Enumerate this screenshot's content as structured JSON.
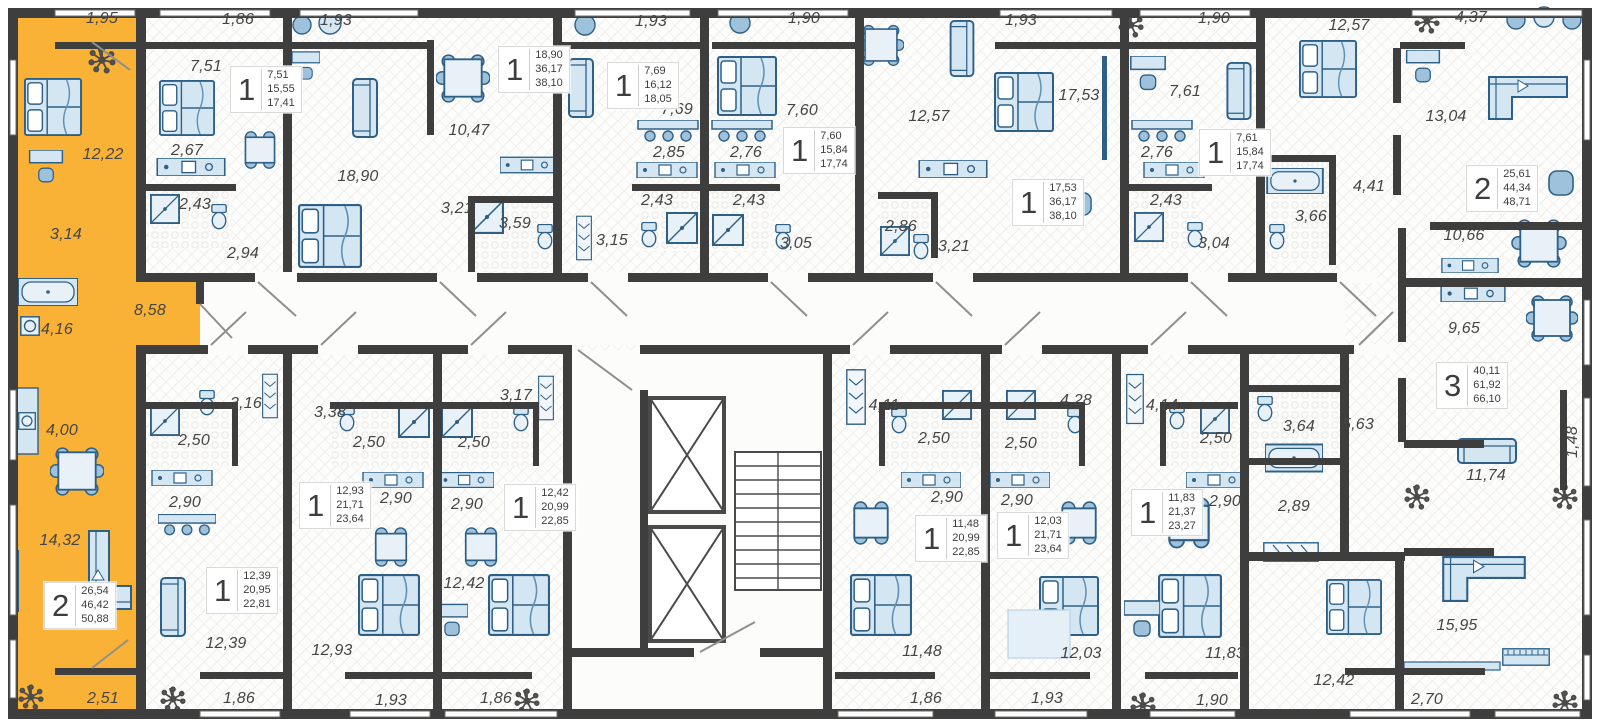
{
  "plan": {
    "wall_color": "#3E3E3E",
    "highlight_color": "#F9B236",
    "furniture_fill": "#D5E6F3",
    "furniture_stroke": "#2E6087",
    "label_color": "#454545"
  },
  "units": [
    {
      "id": "selected-2room",
      "type": "2",
      "highlighted": true,
      "badge": {
        "rooms": "2",
        "areas": [
          "26,54",
          "46,42",
          "50,88"
        ],
        "x": 44,
        "y": 582
      },
      "rooms": [
        {
          "label": "1,95",
          "x": 102,
          "y": 19
        },
        {
          "label": "12,22",
          "x": 103,
          "y": 155
        },
        {
          "label": "3,14",
          "x": 66,
          "y": 235
        },
        {
          "label": "4,16",
          "x": 57,
          "y": 330
        },
        {
          "label": "8,58",
          "x": 150,
          "y": 311
        },
        {
          "label": "4,00",
          "x": 62,
          "y": 431
        },
        {
          "label": "14,32",
          "x": 60,
          "y": 541
        },
        {
          "label": "2,51",
          "x": 103,
          "y": 699
        }
      ]
    },
    {
      "id": "unit-1-a",
      "type": "1",
      "badge": {
        "rooms": "1",
        "areas": [
          "7,51",
          "15,55",
          "17,41"
        ],
        "x": 230,
        "y": 66
      },
      "rooms": [
        {
          "label": "1,86",
          "x": 238,
          "y": 20
        },
        {
          "label": "7,51",
          "x": 206,
          "y": 67
        },
        {
          "label": "2,67",
          "x": 187,
          "y": 151
        },
        {
          "label": "2,43",
          "x": 195,
          "y": 205
        },
        {
          "label": "2,94",
          "x": 243,
          "y": 254
        }
      ]
    },
    {
      "id": "studio-a",
      "type": "1",
      "badge": {
        "rooms": "1",
        "areas": [
          "18,90",
          "36,17",
          "38,10"
        ],
        "x": 498,
        "y": 46
      },
      "rooms": [
        {
          "label": "1,93",
          "x": 336,
          "y": 21
        },
        {
          "label": "18,90",
          "x": 358,
          "y": 177
        },
        {
          "label": "10,47",
          "x": 469,
          "y": 131
        },
        {
          "label": "3,21",
          "x": 457,
          "y": 209
        },
        {
          "label": "3,59",
          "x": 515,
          "y": 224
        }
      ]
    },
    {
      "id": "unit-1-b",
      "type": "1",
      "badge": {
        "rooms": "1",
        "areas": [
          "7,69",
          "16,12",
          "18,05"
        ],
        "x": 607,
        "y": 62
      },
      "rooms": [
        {
          "label": "1,93",
          "x": 651,
          "y": 22
        },
        {
          "label": "7,69",
          "x": 677,
          "y": 110
        },
        {
          "label": "2,85",
          "x": 669,
          "y": 153
        },
        {
          "label": "2,43",
          "x": 657,
          "y": 201
        },
        {
          "label": "3,15",
          "x": 612,
          "y": 241
        }
      ]
    },
    {
      "id": "unit-1-c",
      "type": "1",
      "badge": {
        "rooms": "1",
        "areas": [
          "7,60",
          "15,84",
          "17,74"
        ],
        "x": 783,
        "y": 127
      },
      "rooms": [
        {
          "label": "1,90",
          "x": 804,
          "y": 19
        },
        {
          "label": "7,60",
          "x": 802,
          "y": 111
        },
        {
          "label": "2,76",
          "x": 746,
          "y": 153
        },
        {
          "label": "2,43",
          "x": 749,
          "y": 201
        },
        {
          "label": "3,05",
          "x": 796,
          "y": 244
        }
      ]
    },
    {
      "id": "studio-b",
      "type": "1",
      "badge": {
        "rooms": "1",
        "areas": [
          "17,53",
          "36,17",
          "38,10"
        ],
        "x": 1012,
        "y": 179
      },
      "rooms": [
        {
          "label": "12,57",
          "x": 929,
          "y": 117
        },
        {
          "label": "1,93",
          "x": 1021,
          "y": 21
        },
        {
          "label": "17,53",
          "x": 1079,
          "y": 96
        },
        {
          "label": "2,86",
          "x": 901,
          "y": 227
        },
        {
          "label": "3,21",
          "x": 954,
          "y": 247
        }
      ]
    },
    {
      "id": "unit-1-d",
      "type": "1",
      "badge": {
        "rooms": "1",
        "areas": [
          "7,61",
          "15,84",
          "17,74"
        ],
        "x": 1199,
        "y": 129
      },
      "rooms": [
        {
          "label": "1,90",
          "x": 1214,
          "y": 19
        },
        {
          "label": "7,61",
          "x": 1185,
          "y": 92
        },
        {
          "label": "2,76",
          "x": 1157,
          "y": 153
        },
        {
          "label": "2,43",
          "x": 1166,
          "y": 201
        },
        {
          "label": "3,04",
          "x": 1214,
          "y": 244
        }
      ]
    },
    {
      "id": "unit-2-right",
      "type": "2",
      "badge": {
        "rooms": "2",
        "areas": [
          "25,61",
          "44,34",
          "48,71"
        ],
        "x": 1466,
        "y": 165
      },
      "rooms": [
        {
          "label": "12,57",
          "x": 1349,
          "y": 26
        },
        {
          "label": "4,37",
          "x": 1471,
          "y": 18
        },
        {
          "label": "13,04",
          "x": 1446,
          "y": 117
        },
        {
          "label": "4,41",
          "x": 1369,
          "y": 187
        },
        {
          "label": "3,66",
          "x": 1311,
          "y": 217
        },
        {
          "label": "10,66",
          "x": 1464,
          "y": 236
        }
      ]
    },
    {
      "id": "unit-3-right",
      "type": "3",
      "badge": {
        "rooms": "3",
        "areas": [
          "40,11",
          "61,92",
          "66,10"
        ],
        "x": 1436,
        "y": 362
      },
      "rooms": [
        {
          "label": "9,65",
          "x": 1464,
          "y": 329
        },
        {
          "label": "5,63",
          "x": 1358,
          "y": 425
        },
        {
          "label": "3,64",
          "x": 1299,
          "y": 427
        },
        {
          "label": "2,89",
          "x": 1294,
          "y": 507
        },
        {
          "label": "11,74",
          "x": 1486,
          "y": 476
        },
        {
          "label": "1,48",
          "x": 1573,
          "y": 442,
          "rot": true
        },
        {
          "label": "12,42",
          "x": 1334,
          "y": 681
        },
        {
          "label": "15,95",
          "x": 1457,
          "y": 626
        },
        {
          "label": "2,70",
          "x": 1427,
          "y": 700
        }
      ]
    },
    {
      "id": "unit-1-e",
      "type": "1",
      "badge": {
        "rooms": "1",
        "areas": [
          "12,39",
          "20,95",
          "22,81"
        ],
        "x": 206,
        "y": 567
      },
      "rooms": [
        {
          "label": "3,16",
          "x": 246,
          "y": 404
        },
        {
          "label": "2,50",
          "x": 194,
          "y": 441
        },
        {
          "label": "2,90",
          "x": 185,
          "y": 503
        },
        {
          "label": "12,39",
          "x": 226,
          "y": 644
        },
        {
          "label": "1,86",
          "x": 239,
          "y": 699
        }
      ]
    },
    {
      "id": "unit-1-f",
      "type": "1",
      "badge": {
        "rooms": "1",
        "areas": [
          "12,93",
          "21,71",
          "23,64"
        ],
        "x": 299,
        "y": 482
      },
      "rooms": [
        {
          "label": "3,38",
          "x": 330,
          "y": 413
        },
        {
          "label": "2,50",
          "x": 369,
          "y": 443
        },
        {
          "label": "2,90",
          "x": 396,
          "y": 499
        },
        {
          "label": "12,93",
          "x": 332,
          "y": 651
        },
        {
          "label": "1,93",
          "x": 391,
          "y": 701
        }
      ]
    },
    {
      "id": "unit-1-g",
      "type": "1",
      "badge": {
        "rooms": "1",
        "areas": [
          "12,42",
          "20,99",
          "22,85"
        ],
        "x": 504,
        "y": 484
      },
      "rooms": [
        {
          "label": "3,17",
          "x": 516,
          "y": 396
        },
        {
          "label": "2,50",
          "x": 474,
          "y": 443
        },
        {
          "label": "2,90",
          "x": 467,
          "y": 505
        },
        {
          "label": "12,42",
          "x": 464,
          "y": 584
        },
        {
          "label": "1,86",
          "x": 496,
          "y": 699
        }
      ]
    },
    {
      "id": "unit-1-h",
      "type": "1",
      "badge": {
        "rooms": "1",
        "areas": [
          "11,48",
          "20,99",
          "22,85"
        ],
        "x": 915,
        "y": 515
      },
      "rooms": [
        {
          "label": "4,11",
          "x": 884,
          "y": 406
        },
        {
          "label": "2,50",
          "x": 934,
          "y": 439
        },
        {
          "label": "2,90",
          "x": 947,
          "y": 498
        },
        {
          "label": "11,48",
          "x": 922,
          "y": 652
        },
        {
          "label": "1,86",
          "x": 926,
          "y": 699
        }
      ]
    },
    {
      "id": "unit-1-i",
      "type": "1",
      "badge": {
        "rooms": "1",
        "areas": [
          "12,03",
          "21,71",
          "23,64"
        ],
        "x": 997,
        "y": 512
      },
      "rooms": [
        {
          "label": "4,28",
          "x": 1076,
          "y": 401
        },
        {
          "label": "2,50",
          "x": 1021,
          "y": 444
        },
        {
          "label": "2,90",
          "x": 1017,
          "y": 501
        },
        {
          "label": "12,03",
          "x": 1081,
          "y": 654
        },
        {
          "label": "1,93",
          "x": 1047,
          "y": 699
        }
      ]
    },
    {
      "id": "unit-1-j",
      "type": "1",
      "badge": {
        "rooms": "1",
        "areas": [
          "11,83",
          "21,37",
          "23,27"
        ],
        "x": 1131,
        "y": 489
      },
      "rooms": [
        {
          "label": "4,14",
          "x": 1162,
          "y": 406
        },
        {
          "label": "2,50",
          "x": 1216,
          "y": 439
        },
        {
          "label": "2,90",
          "x": 1225,
          "y": 502
        },
        {
          "label": "11,83",
          "x": 1225,
          "y": 654
        },
        {
          "label": "1,90",
          "x": 1212,
          "y": 701
        }
      ]
    }
  ]
}
